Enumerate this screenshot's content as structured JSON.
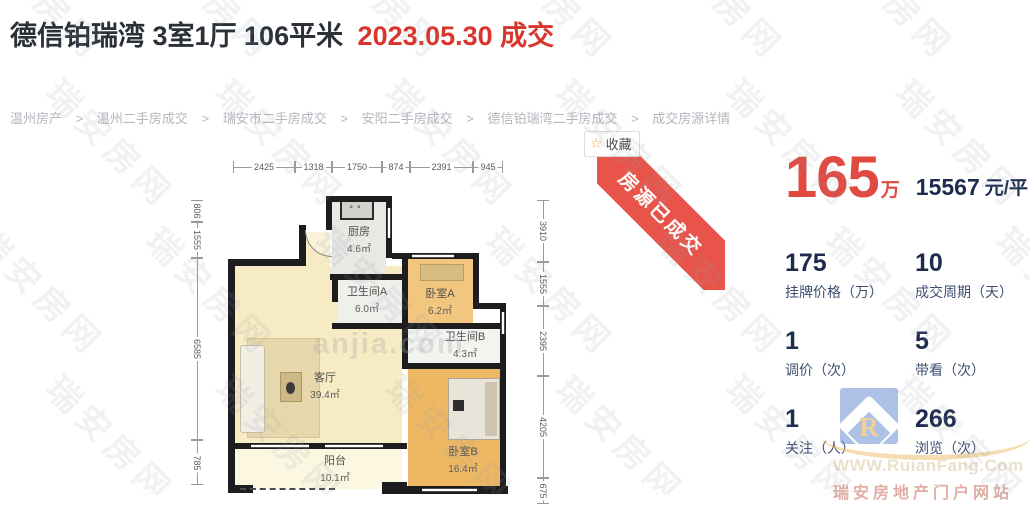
{
  "header": {
    "title_main": "德信铂瑞湾 3室1厅 106平米",
    "title_deal": "2023.05.30 成交"
  },
  "breadcrumb": {
    "separator": ">",
    "items": [
      "温州房产",
      "温州二手房成交",
      "瑞安市二手房成交",
      "安阳二手房成交",
      "德信铂瑞湾二手房成交",
      "成交房源详情"
    ]
  },
  "actions": {
    "favorite_label": "收藏",
    "favorite_icon": "star-icon"
  },
  "ribbon": {
    "label": "房源已成交",
    "color": "#e8544a"
  },
  "price": {
    "value": "165",
    "unit": "万",
    "per_sqm": "15567",
    "per_sqm_unit": "元/平"
  },
  "stats": [
    {
      "value": "175",
      "label": "挂牌价格（万）"
    },
    {
      "value": "10",
      "label": "成交周期（天）"
    },
    {
      "value": "1",
      "label": "调价（次）"
    },
    {
      "value": "5",
      "label": "带看（次）"
    },
    {
      "value": "1",
      "label": "关注（人）"
    },
    {
      "value": "266",
      "label": "浏览（次）"
    }
  ],
  "floorplan": {
    "dims_top": [
      "2425",
      "1318",
      "1750",
      "874",
      "2391",
      "945"
    ],
    "dims_left": [
      "806",
      "1555",
      "6585",
      "785"
    ],
    "dims_right": [
      "3910",
      "1555",
      "2395",
      "4205",
      "675"
    ],
    "rooms": [
      {
        "name": "厨房",
        "area": "4.6㎡"
      },
      {
        "name": "卫生间A",
        "area": "6.0㎡"
      },
      {
        "name": "卧室A",
        "area": "6.2㎡"
      },
      {
        "name": "卫生间B",
        "area": "4.3㎡"
      },
      {
        "name": "客厅",
        "area": "39.4㎡"
      },
      {
        "name": "卧室B",
        "area": "16.4㎡"
      },
      {
        "name": "阳台",
        "area": "10.1㎡"
      }
    ],
    "inner_watermark": "anjia.com"
  },
  "watermark": {
    "text": "瑞安房网"
  },
  "site_logo": {
    "letter": "R",
    "url_text": "WWW.RuianFang.Com",
    "slogan": "瑞安房地产门户网站"
  },
  "colors": {
    "accent_red": "#d8352d",
    "price_red": "#e04a40",
    "navy": "#1d2c4e",
    "ribbon_red": "#e8544a",
    "living_floor": "#f6ebc3",
    "bedroom_floor": "#efc07a",
    "bath_floor": "#eeeeeb",
    "wall": "#1d1d20"
  }
}
